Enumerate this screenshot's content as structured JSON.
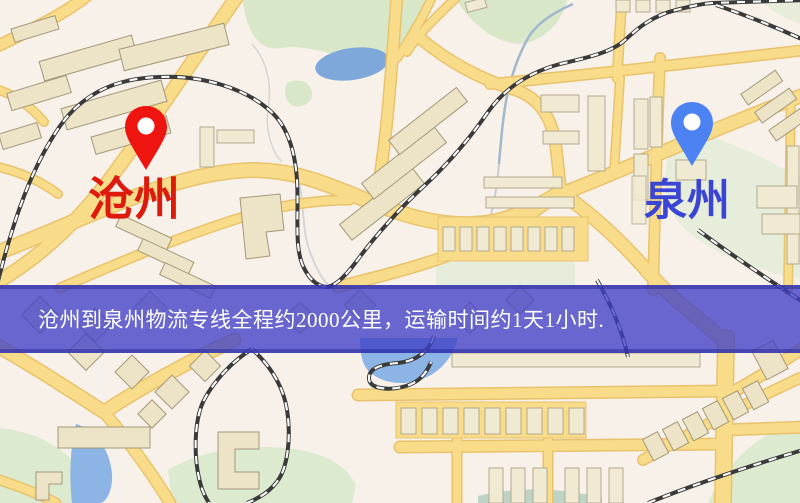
{
  "markers": {
    "origin": {
      "label": "沧州",
      "pin_color": "#ee1511",
      "label_color": "#de1a0c"
    },
    "destination": {
      "label": "泉州",
      "pin_color": "#4d82f2",
      "label_color": "#3b45d4"
    }
  },
  "banner": {
    "text": "沧州到泉州物流专线全程约2000公里，运输时间约1天1小时.",
    "background_color": "#4a4ac9",
    "text_color": "#ffffff"
  },
  "map": {
    "background_color": "#f8f1ea",
    "road_color": "#f8dc8a",
    "road_casing_color": "#e9c36c",
    "building_color": "#ede4c8",
    "park_color": "#d7e7c8",
    "water_color": "#7ea8da",
    "railway_color": "#3a3a3a",
    "icons": [
      "red-map-pin-icon",
      "blue-map-pin-icon"
    ]
  }
}
